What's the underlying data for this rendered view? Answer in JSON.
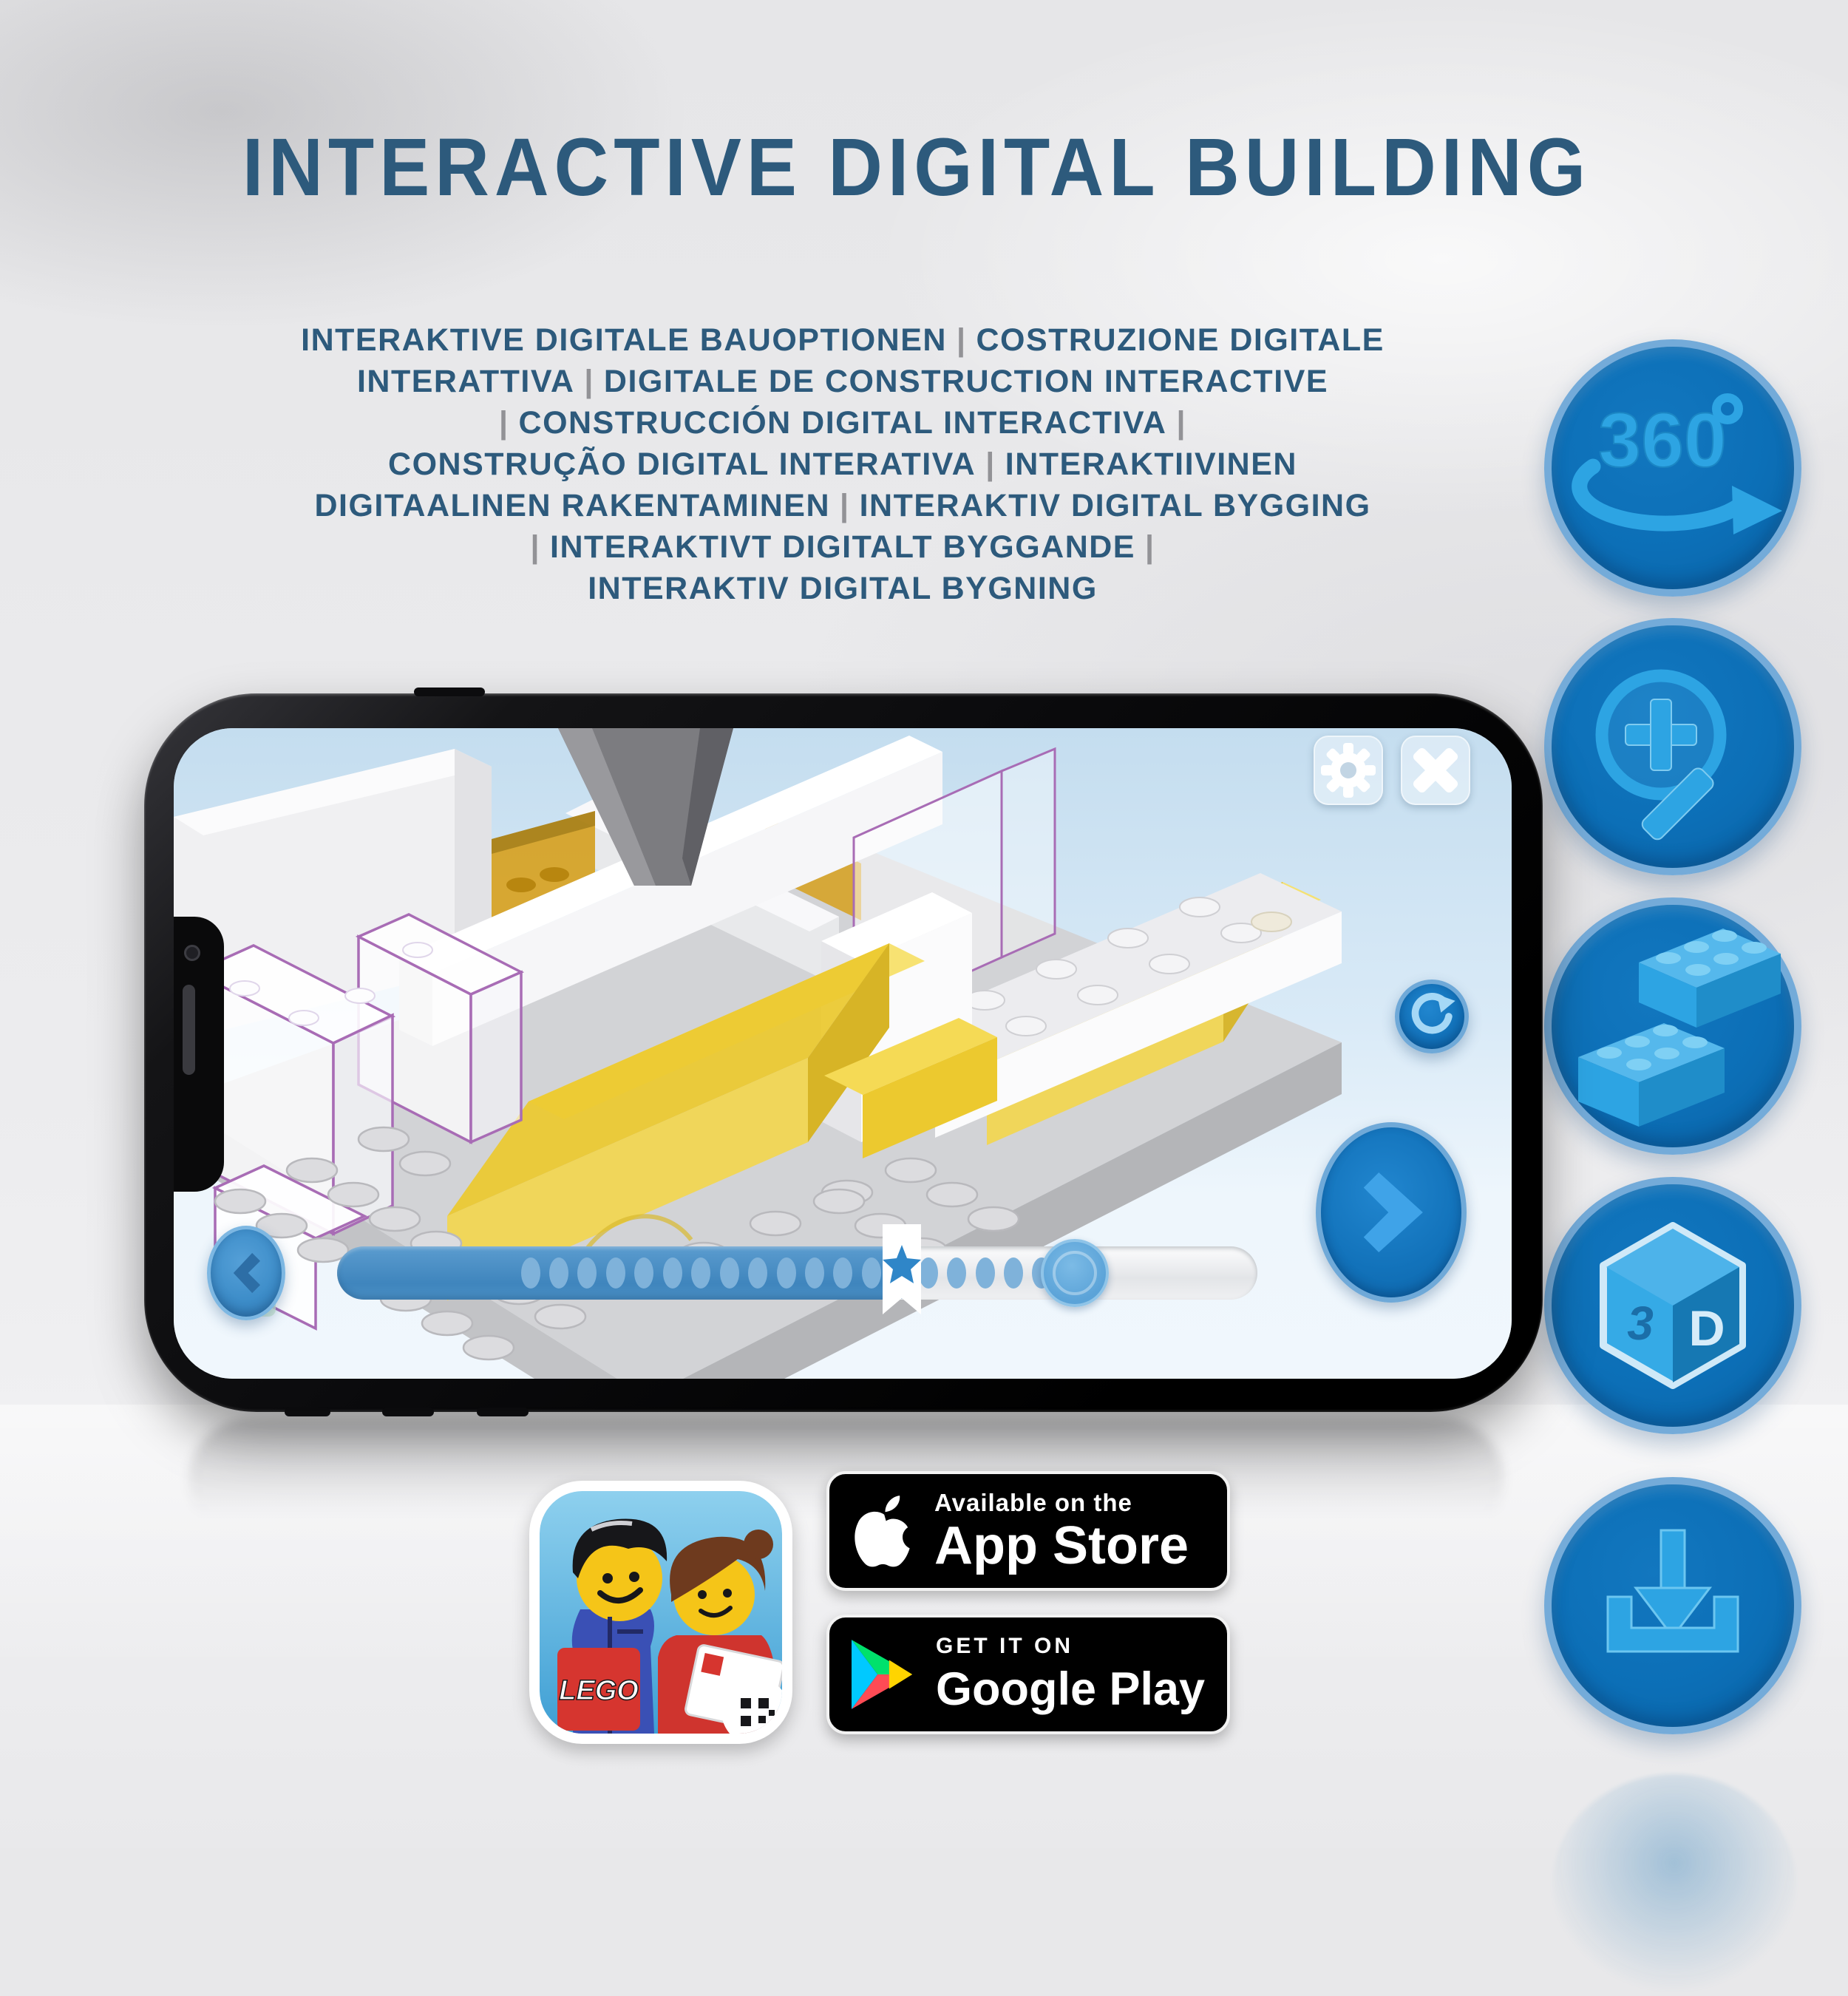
{
  "header": {
    "title": "INTERACTIVE DIGITAL BUILDING",
    "subtitle_lines": [
      "INTERAKTIVE DIGITALE BAUOPTIONEN | COSTRUZIONE DIGITALE",
      "INTERATTIVA | DIGITALE DE CONSTRUCTION INTERACTIVE",
      "| CONSTRUCCIÓN DIGITAL INTERACTIVA |",
      "CONSTRUÇÃO DIGITAL INTERATIVA | INTERAKTIIVINEN",
      "DIGITAALINEN RAKENTAMINEN | INTERAKTIV DIGITAL BYGGING",
      "| INTERAKTIVT DIGITALT BYGGANDE |",
      "INTERAKTIV DIGITAL BYGNING"
    ]
  },
  "feature_icons": {
    "rotation_360": {
      "label_number": "360",
      "label_degree": "°"
    },
    "zoom": {
      "name": "magnifier-zoom"
    },
    "bricks": {
      "name": "lego-bricks"
    },
    "cube_3d": {
      "left_face": "3",
      "right_face": "D"
    },
    "download": {
      "name": "download"
    }
  },
  "phone_app": {
    "controls": {
      "settings": "settings-gear",
      "close": "close",
      "rotate_view": "rotate-reset",
      "previous_step": "previous",
      "next_step": "next"
    },
    "progress": {
      "filled_ratio": 0.62,
      "star_marker_ratio": 0.44,
      "visible_dot_count": 19
    }
  },
  "store_badges": {
    "app_store": {
      "line1": "Available on the",
      "line2": "App Store"
    },
    "google_play": {
      "line1": "GET IT ON",
      "line2": "Google Play"
    }
  },
  "app_tile": {
    "logo_text": "LEGO"
  },
  "colors": {
    "headline_text": "#2d5a7c",
    "separator_pipe": "#929296",
    "feature_circle_fill": "#0c6fb7",
    "feature_circle_border": "#74abd9",
    "feature_glyph": "#2da4e3",
    "badge_background": "#000000",
    "progress_filled": "#4a8fc4",
    "yellow_brick": "#ecc92f",
    "ghost_outline": "#a86cb5",
    "lego_logo_red": "#d6352f"
  }
}
